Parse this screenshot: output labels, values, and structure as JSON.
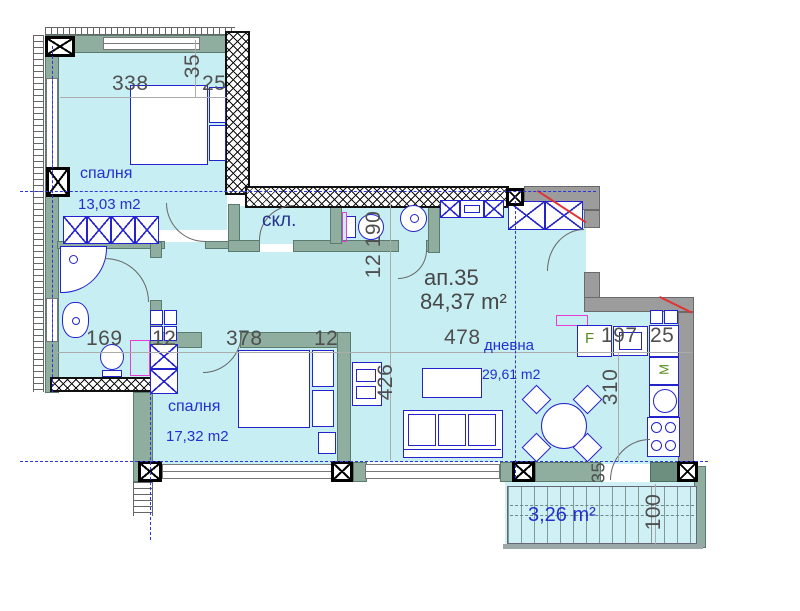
{
  "apartment": {
    "number": "ап.35",
    "area": "84,37 m²"
  },
  "rooms": {
    "bedroom1": {
      "name": "спалня",
      "area": "13,03 m2"
    },
    "bedroom2": {
      "name": "спалня",
      "area": "17,32 m2"
    },
    "living": {
      "name": "дневна",
      "area": "29,61 m2"
    },
    "storage": {
      "name": "скл."
    },
    "balcony": {
      "area": "3,26 m²"
    }
  },
  "dims": {
    "d338": "338",
    "d35a": "35",
    "d25a": "25",
    "d169": "169",
    "d12a": "12",
    "d190": "190",
    "d12b": "12",
    "d378": "378",
    "d12c": "12",
    "d426": "426",
    "d478": "478",
    "d197": "197",
    "d25b": "25",
    "d310": "310",
    "d35b": "35",
    "d100": "100"
  },
  "appliances": {
    "fridge": "F",
    "microwave": "M"
  },
  "colors": {
    "floor": "#c7eef3",
    "wall": "#8fae9f",
    "wall_gray": "#9c9c9c",
    "furniture_line": "#2323cc",
    "label_blue": "#2330cf",
    "dim_gray": "#4f4f4f",
    "accent_red": "#e23333",
    "accent_magenta": "#e33fd4",
    "appliance_green": "#568c1e"
  }
}
